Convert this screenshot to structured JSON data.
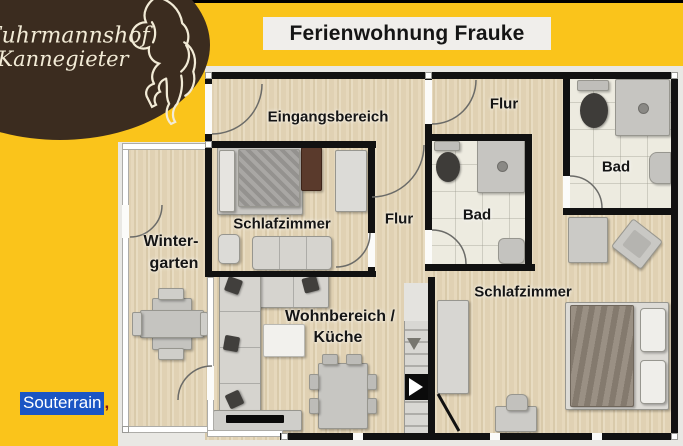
{
  "page": {
    "background_color": "#FAC41B",
    "top_border_color": "#000000"
  },
  "logo": {
    "line1": "Fuhrmannshof",
    "line2": "Kannegieter",
    "bg_color": "#3B2C1F",
    "text_color": "#F2EBD6",
    "icon": "horse-outline"
  },
  "title": {
    "text": "Ferienwohnung Frauke",
    "bg_color": "#F0EEEB",
    "color": "#151515"
  },
  "selection": {
    "text": "Souterrain",
    "suffix": ",",
    "bg_color": "#1B55C4",
    "color": "#FFFFFF"
  },
  "floorplan": {
    "colors": {
      "wall": "#111111",
      "wood": "#E4D6B8",
      "tile": "#EDEBE0",
      "photo_bg": "#E9E8E4"
    },
    "rooms": {
      "eingangsbereich": "Eingangsbereich",
      "flur_top": "Flur",
      "bad_top_right": "Bad",
      "schlafzimmer_left": "Schlafzimmer",
      "flur_middle": "Flur",
      "bad_middle": "Bad",
      "wintergarten_line1": "Winter-",
      "wintergarten_line2": "garten",
      "wohnbereich_line1": "Wohnbereich /",
      "wohnbereich_line2": "Küche",
      "schlafzimmer_right": "Schlafzimmer"
    }
  }
}
